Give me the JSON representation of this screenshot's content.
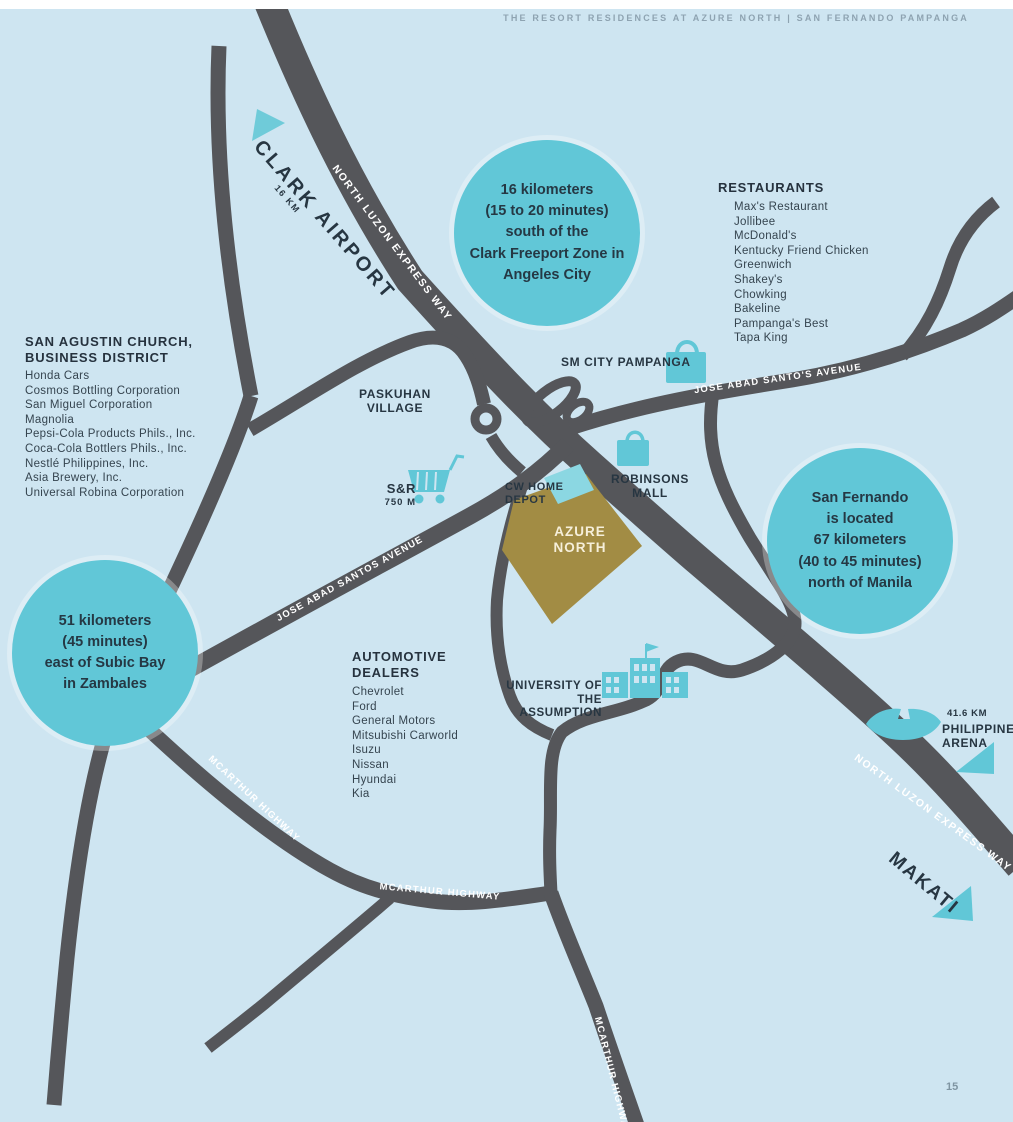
{
  "page_header": "THE RESORT RESIDENCES AT AZURE NORTH  |  SAN FERNANDO PAMPANGA",
  "page_number": "15",
  "colors": {
    "background": "#cee5f1",
    "road": "#55565a",
    "teal_accent": "#61c7d7",
    "parcel_gold": "#a28c44",
    "text_navy": "#273642",
    "road_text": "#ffffff"
  },
  "callouts": {
    "clark_freeport": "16 kilometers\n(15 to 20 minutes)\nsouth of the\nClark Freeport Zone in\nAngeles City",
    "san_fernando": "San Fernando\nis located\n67 kilometers\n(40 to 45 minutes)\nnorth of Manila",
    "subic": "51 kilometers\n(45 minutes)\neast of Subic Bay\nin Zambales"
  },
  "roads": {
    "nlex": "NORTH LUZON EXPRESS WAY",
    "jasa_east": "JOSE ABAD SANTO'S AVENUE",
    "jasa_west": "JOSE ABAD SANTOS AVENUE",
    "mcarthur": "MCARTHUR HIGHWAY"
  },
  "landmarks": {
    "clark_airport": {
      "label": "CLARK AIRPORT",
      "distance": "16 KM"
    },
    "paskuhan": {
      "label": "PASKUHAN\nVILLAGE"
    },
    "sm_city": {
      "label": "SM CITY PAMPANGA"
    },
    "sr": {
      "label": "S&R",
      "distance": "750 M"
    },
    "cw_home_depot": {
      "label": "CW HOME\nDEPOT"
    },
    "azure_north": {
      "label": "AZURE\nNORTH"
    },
    "robinsons": {
      "label": "ROBINSONS\nMALL"
    },
    "university": {
      "label": "UNIVERSITY OF THE\nASSUMPTION"
    },
    "philippine_arena": {
      "label": "PHILIPPINE\nARENA",
      "distance": "41.6 KM"
    },
    "makati": {
      "label": "MAKATI"
    }
  },
  "lists": {
    "restaurants": {
      "title": "RESTAURANTS",
      "items": [
        "Max's Restaurant",
        "Jollibee",
        "McDonald's",
        "Kentucky Friend Chicken",
        "Greenwich",
        "Shakey's",
        "Chowking",
        "Bakeline",
        "Pampanga's Best",
        "Tapa King"
      ]
    },
    "business_district": {
      "title": "SAN AGUSTIN CHURCH,\nBUSINESS DISTRICT",
      "items": [
        "Honda Cars",
        "Cosmos Bottling Corporation",
        "San Miguel Corporation",
        "Magnolia",
        "Pepsi-Cola Products Phils., Inc.",
        "Coca-Cola Bottlers Phils., Inc.",
        "Nestlé Philippines, Inc.",
        "Asia Brewery, Inc.",
        "Universal Robina Corporation"
      ]
    },
    "automotive": {
      "title": "AUTOMOTIVE\nDEALERS",
      "items": [
        "Chevrolet",
        "Ford",
        "General Motors",
        "Mitsubishi Carworld",
        "Isuzu",
        "Nissan",
        "Hyundai",
        "Kia"
      ]
    }
  },
  "icons": {
    "clark_arrow": "triangle-arrow",
    "arena_arrow": "triangle-arrow",
    "makati_arrow": "triangle-arrow",
    "sm_city": "shopping-bag",
    "robinsons": "shopping-bag",
    "sr": "shopping-cart",
    "university": "school-building",
    "philippine_arena": "stadium",
    "roundabout": "roundabout-ring"
  }
}
